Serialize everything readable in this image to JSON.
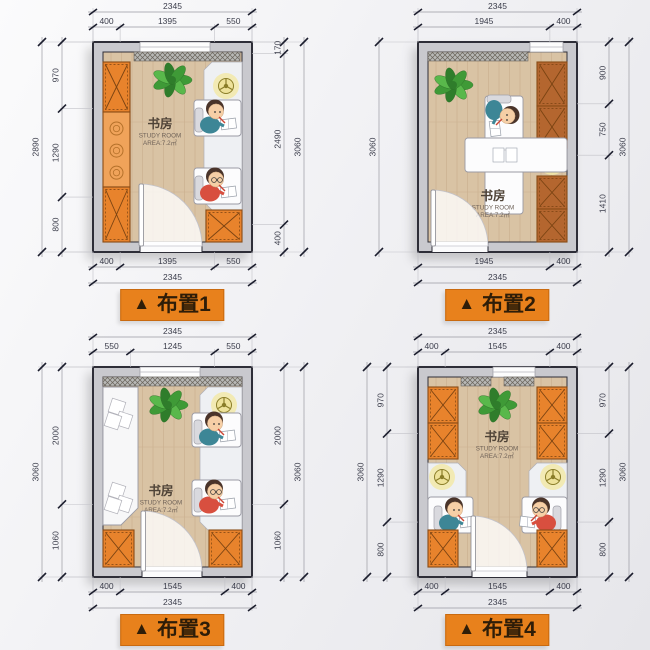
{
  "ui": {
    "badge_icon": "▲",
    "colors": {
      "badge_bg": "#e8811c",
      "badge_text": "#2e1d08",
      "wall": "#c9c9ce",
      "wall_line": "#2e2e38",
      "floor": "#d9c3a4",
      "plank": "#cab190",
      "orange": "#e8832c",
      "orange_light": "#f0a35a",
      "brown": "#b4662f",
      "alcove": "#eef0f3",
      "lamp_glow": "#f2e9a8",
      "plant_green": "#4aa53c",
      "dim_text": "#3a3c4a",
      "tick": "#1c1e2e",
      "dim_line": "#9a9aa2",
      "teal_shirt": "#3d8696",
      "red_shirt": "#d84f3f"
    }
  },
  "room": {
    "name": "书房",
    "name_en": "STUDY ROOM",
    "area": "AREA:7.2㎡"
  },
  "plans": [
    {
      "id": "1",
      "badge": "布置1",
      "furniture": [
        "wardrobe-left",
        "shelf-top",
        "plant",
        "desk-kid-top",
        "desk-kid-bottom",
        "ceiling-lamp",
        "cabinet-bottom-right",
        "door"
      ],
      "dims": {
        "top": {
          "segments": [
            400,
            1395,
            550
          ],
          "total": "2345"
        },
        "bottom": {
          "segments": [
            400,
            1395,
            550
          ],
          "total": "2345"
        },
        "left": {
          "segments": [
            970,
            1290,
            800
          ],
          "total": "2890"
        },
        "right": {
          "segments": [
            170,
            2490,
            400
          ],
          "total": "3060"
        }
      }
    },
    {
      "id": "2",
      "badge": "布置2",
      "furniture": [
        "shelf-top",
        "plant",
        "wardrobe-right-top",
        "center-desk",
        "kid",
        "ceiling-lamp",
        "wardrobe-right-bottom",
        "door"
      ],
      "dims": {
        "top": {
          "segments": [
            1945,
            400
          ],
          "total": "2345"
        },
        "bottom": {
          "segments": [
            1945,
            400
          ],
          "total": "2345"
        },
        "left": {
          "segments": [],
          "total": "3060"
        },
        "right": {
          "segments": [
            900,
            750,
            1410
          ],
          "total": "3060"
        }
      }
    },
    {
      "id": "3",
      "badge": "布置3",
      "furniture": [
        "shelf-top",
        "plant",
        "daybed-left",
        "desk-kid-top",
        "desk-kid-bottom",
        "ceiling-lamp",
        "cabinet-bottom-left",
        "cabinet-bottom-right",
        "door"
      ],
      "dims": {
        "top": {
          "segments": [
            550,
            1245,
            550
          ],
          "total": "2345"
        },
        "bottom": {
          "segments": [
            400,
            1545,
            400
          ],
          "total": "2345"
        },
        "left": {
          "segments": [
            2000,
            1060
          ],
          "total": "3060"
        },
        "right": {
          "segments": [
            2000,
            1060
          ],
          "total": "3060"
        }
      }
    },
    {
      "id": "4",
      "badge": "布置4",
      "furniture": [
        "wardrobe-top-left",
        "shelf-top",
        "plant",
        "wardrobe-top-right",
        "alcove-desk-left",
        "alcove-desk-right",
        "lamp-left",
        "lamp-right",
        "cabinet-bottom-left",
        "cabinet-bottom-right",
        "door"
      ],
      "dims": {
        "top": {
          "segments": [
            400,
            1545,
            400
          ],
          "total": "2345"
        },
        "bottom": {
          "segments": [
            400,
            1545,
            400
          ],
          "total": "2345"
        },
        "left": {
          "segments": [
            970,
            1290,
            800
          ],
          "total": "3060"
        },
        "right": {
          "segments": [
            970,
            1290,
            800
          ],
          "total": "3060"
        }
      }
    }
  ]
}
